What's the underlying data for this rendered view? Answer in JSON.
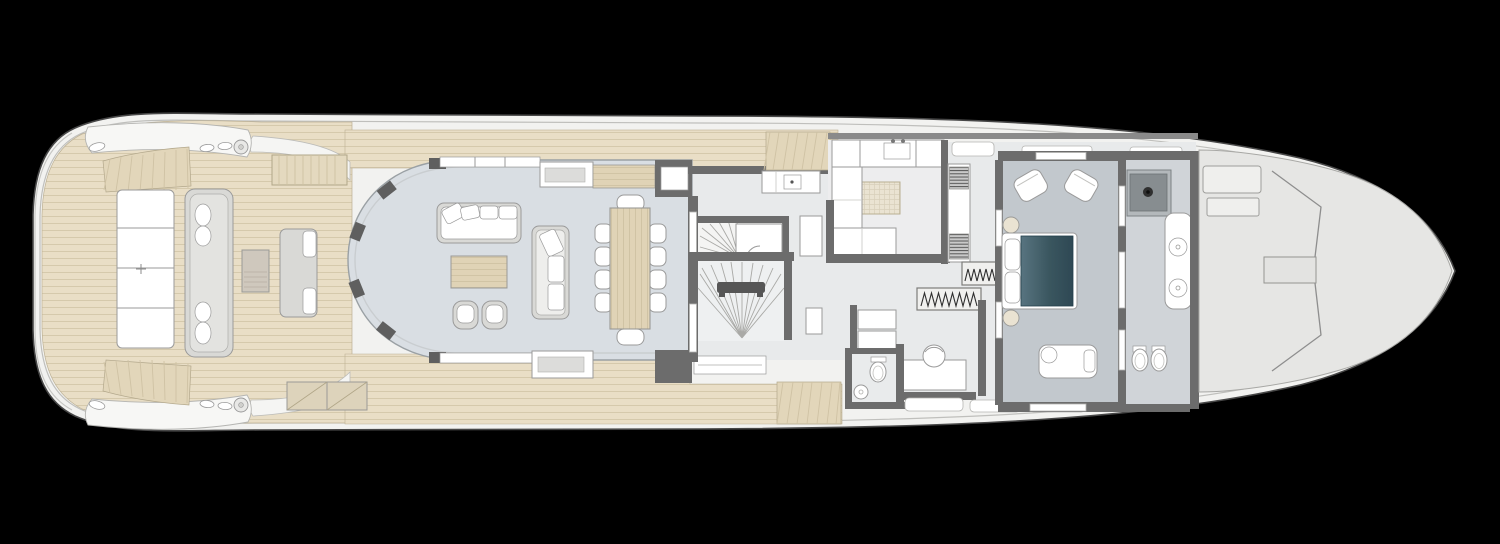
{
  "document": {
    "kind": "yacht-main-deck-floor-plan",
    "visible_text": []
  },
  "colors": {
    "background": "#000000",
    "hull_fill": "#f2f2f0",
    "hull_stroke": "#474747",
    "bulwark_line": "#bfbfbc",
    "bow_deck": "#e6e6e4",
    "teak": "#e9dec6",
    "teak_line": "#cfc2a4",
    "teak_step": "#e2d6ba",
    "salon_floor": "#d9dee3",
    "interior_floor": "#e8eaeb",
    "master_floor": "#c2c8cd",
    "bath_floor": "#d0d4d8",
    "galley_floor": "#ededee",
    "wall": "#6c6c6c",
    "wall_light": "#8a8a8a",
    "outline": "#9a9a9a",
    "furniture_fill": "#ffffff",
    "sofa_gray": "#d9d9d6",
    "wood": "#e0d3b6",
    "wood_line": "#cdbf9f",
    "cream": "#eae3d2",
    "grid_line": "#d8cfba",
    "bed_dark": "#2e4854",
    "bed_light": "#587480",
    "appliance_fill": "#c9c9c9",
    "appliance_line": "#555555",
    "glass_line": "#c9cdd0",
    "shower_head": "#878d90",
    "shower_pan": "#b3b8bb"
  }
}
